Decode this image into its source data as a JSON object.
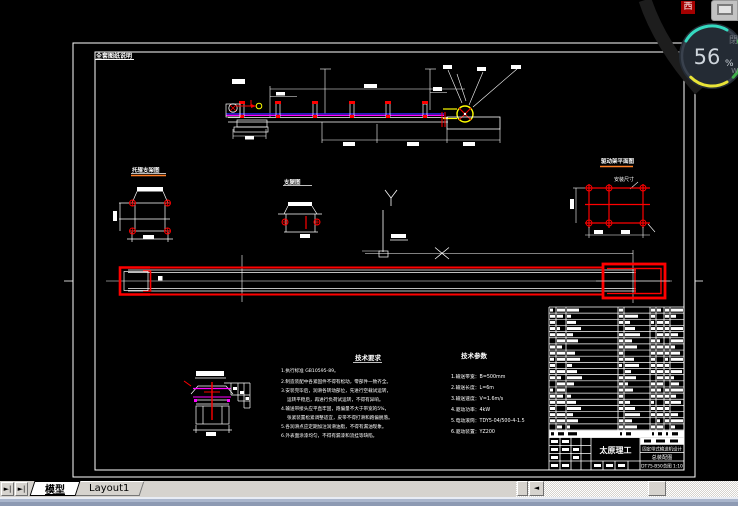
{
  "chrome": {
    "red_badge": "西",
    "zoom_percent": "56",
    "percent_sign": "%",
    "behind_glyph_1": "閉",
    "behind_glyph_2": "w"
  },
  "tab_bar": {
    "nav_button_1": "►|",
    "nav_button_2": "►|",
    "tab_model": "模型",
    "tab_layout1": "Layout1"
  },
  "sheet": {
    "top_label": "全套图纸说明",
    "section_labels": {
      "roller_bracket": "托辊支架图",
      "leg": "支腿图",
      "drive_frame": "驱动架平面图",
      "drive_frame_sub": "安装尺寸",
      "tension": "拉紧装置",
      "trough": "槽形托辊图"
    },
    "notes": {
      "title": "技术要求",
      "lines": [
        "1.执行标准 GB10595-89。",
        "2.制造装配中各紧固件不得有松动，零部件一致齐全。",
        "3.安装完毕后，润滑各转动部位，先进行空载试运转，",
        "运转平稳后，再进行负荷试运转，不得有异响。",
        "4.输送带接头应平直牢固，跑偏量不大于带宽的5%，",
        "张紧装置松紧调整适宜，皮带不得打滑和跑偏脱落。",
        "5.各润滑点应定期加注润滑油脂，不得有漏油现象。",
        "6.外表面涂漆均匀，不得有漏漆和流挂等缺陷。"
      ]
    },
    "params": {
      "title": "技术参数",
      "lines": [
        "1.输送带宽：B=500mm",
        "2.输送长度：L=6m",
        "3.输送速度：V=1.6m/s",
        "4.驱动功率：4kW",
        "5.电动滚筒：TDY5-04/500-4-1.5",
        "6.驱动装置：YZ200"
      ]
    },
    "title_block": {
      "company": "太原理工",
      "project": "固定带式输送机设计",
      "drawing_name": "总装配图",
      "drawing_no": "DT75-B50总图 1:10"
    },
    "parts_table": {
      "row_count": 20
    }
  }
}
